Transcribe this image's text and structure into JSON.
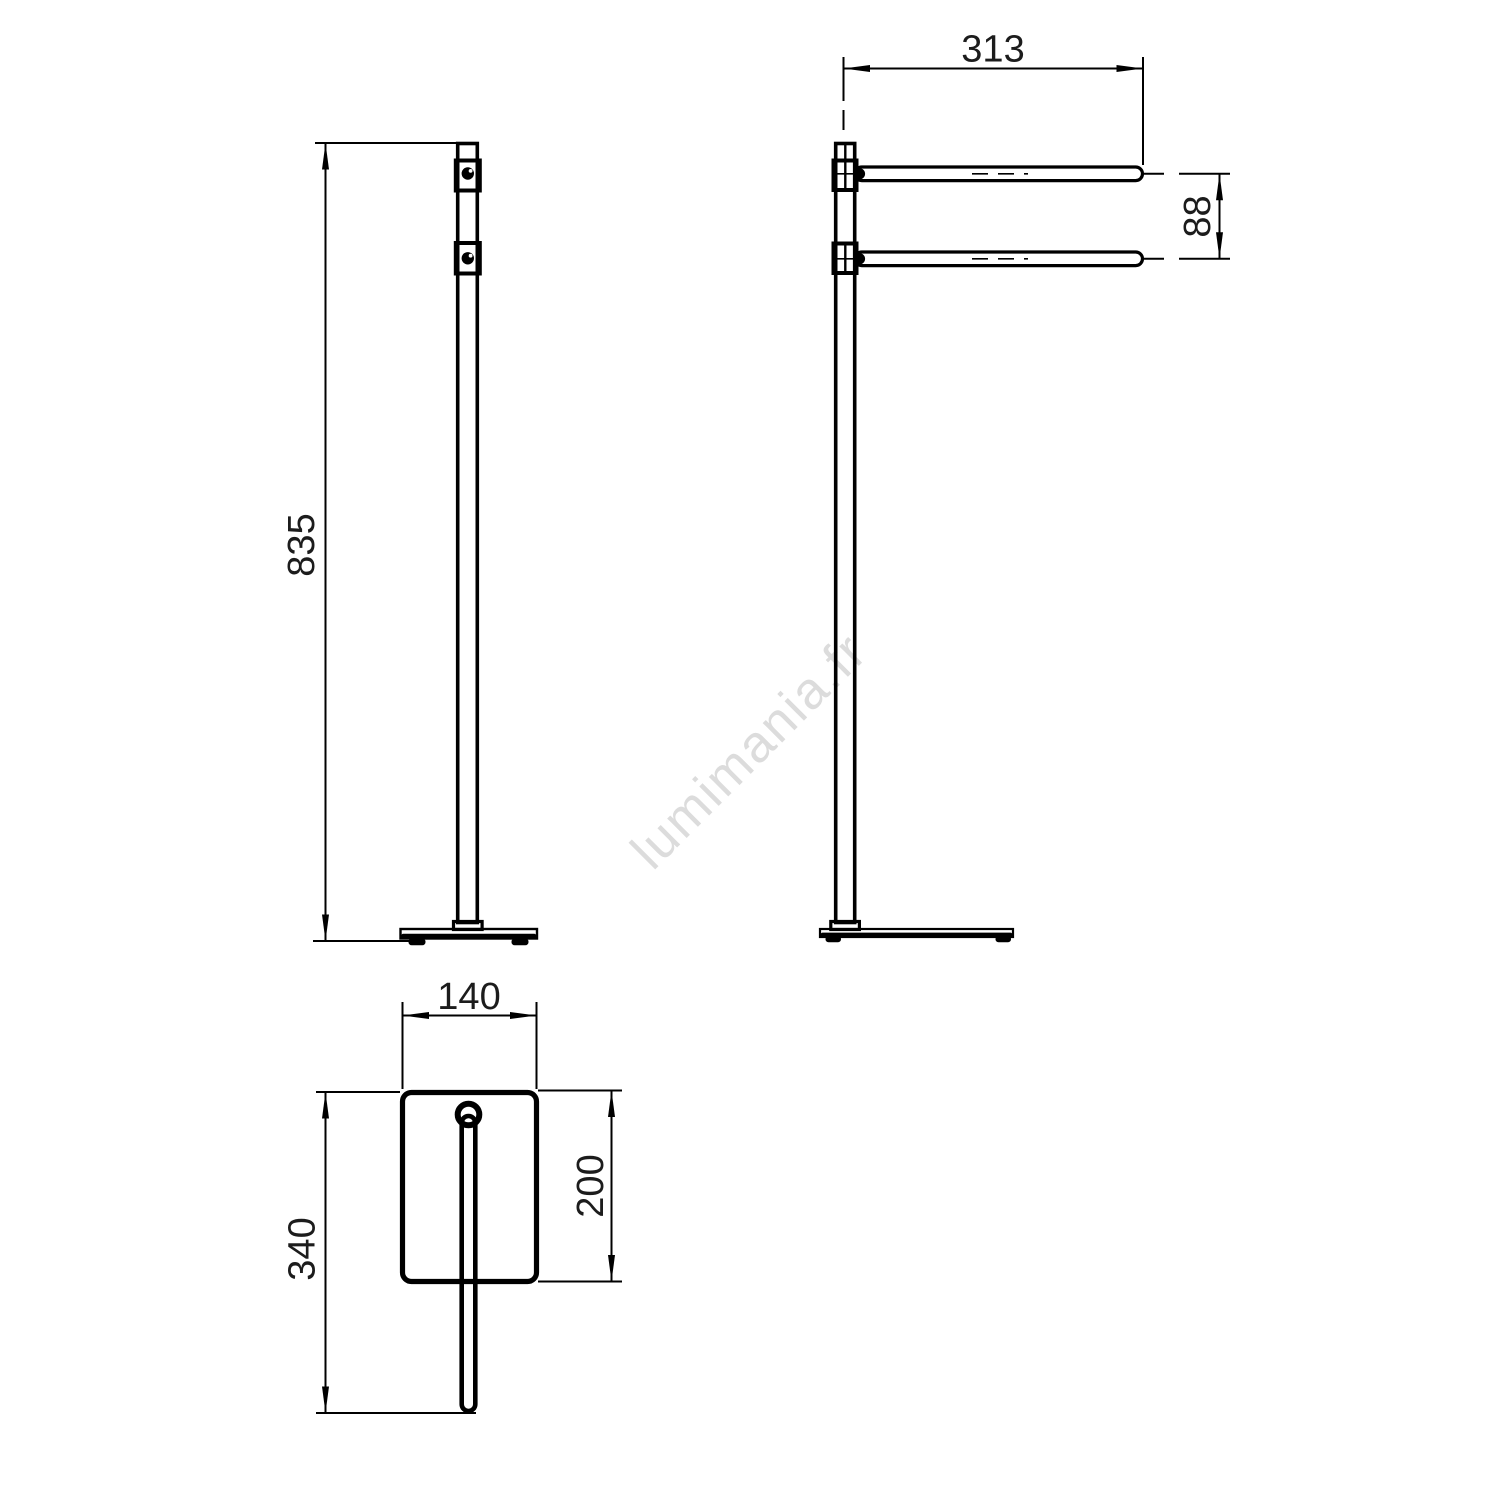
{
  "drawing": {
    "type": "technical-dimension-drawing",
    "line_color": "#000000",
    "background_color": "#ffffff",
    "watermark": {
      "text": "lumimania.fr",
      "color": "#dcdcdc"
    },
    "views": {
      "front": {
        "name": "front view"
      },
      "side": {
        "name": "side view"
      },
      "top": {
        "name": "top view"
      }
    },
    "dimensions": {
      "overall_height": {
        "label": "835"
      },
      "arm_length": {
        "label": "313"
      },
      "arm_spacing": {
        "label": "88"
      },
      "base_width": {
        "label": "140"
      },
      "base_depth": {
        "label": "200"
      },
      "overall_depth": {
        "label": "340"
      }
    }
  }
}
